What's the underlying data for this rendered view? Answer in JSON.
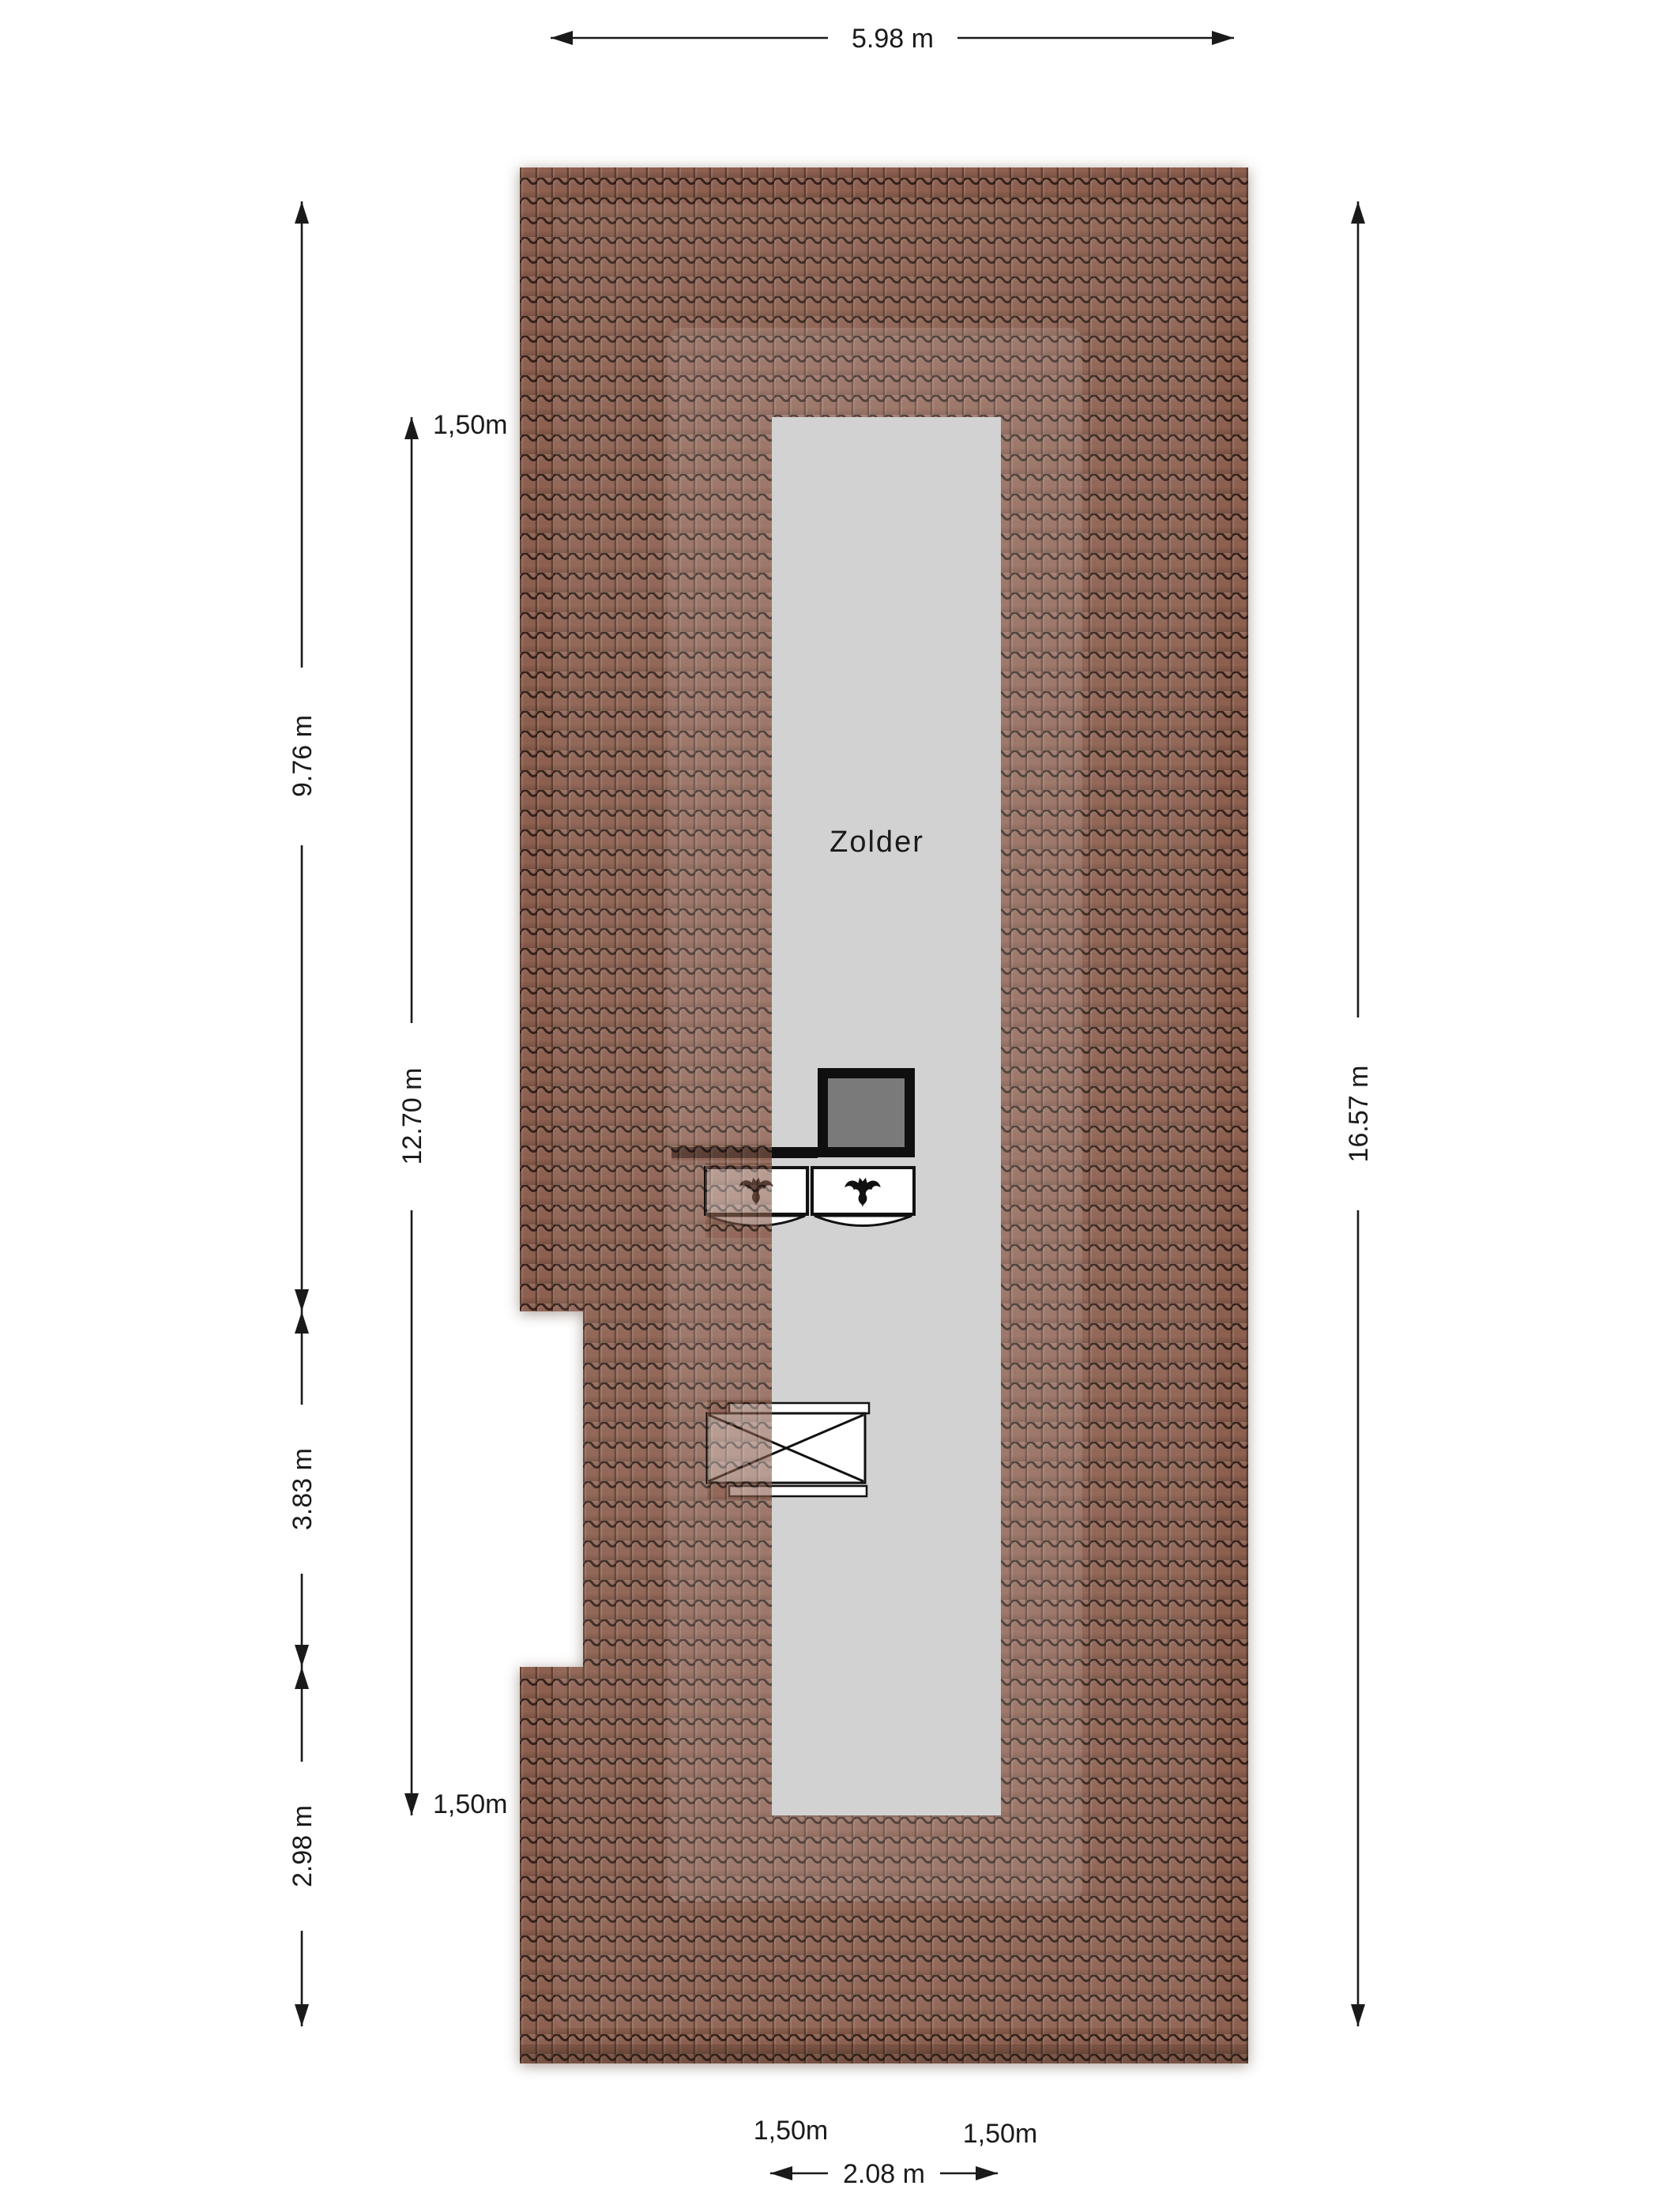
{
  "floorplan": {
    "room_label": "Zolder",
    "dimensions": {
      "top_width": "5.98 m",
      "left_upper": "9.76 m",
      "left_middle": "3.83 m",
      "left_lower": "2.98 m",
      "interior_length": "12.70 m",
      "right_height": "16.57 m",
      "bottom_width": "2.08 m"
    },
    "headroom_labels": {
      "interior_top": "1,50m",
      "interior_bottom": "1,50m",
      "bottom_left": "1,50m",
      "bottom_right": "1,50m"
    },
    "colors": {
      "roof_tile_base": "#8e604f",
      "roof_tile_line": "#241510",
      "roof_band_highlight": "#ffffff",
      "room_fill": "#d2d2d2",
      "chimney_fill": "#7a7a7a",
      "chimney_border": "#0f0f0f",
      "line_color": "#1a1a1a"
    },
    "icons": {
      "window_symbol": "bat-icon",
      "stair_opening_symbol": "crossed-void"
    }
  }
}
